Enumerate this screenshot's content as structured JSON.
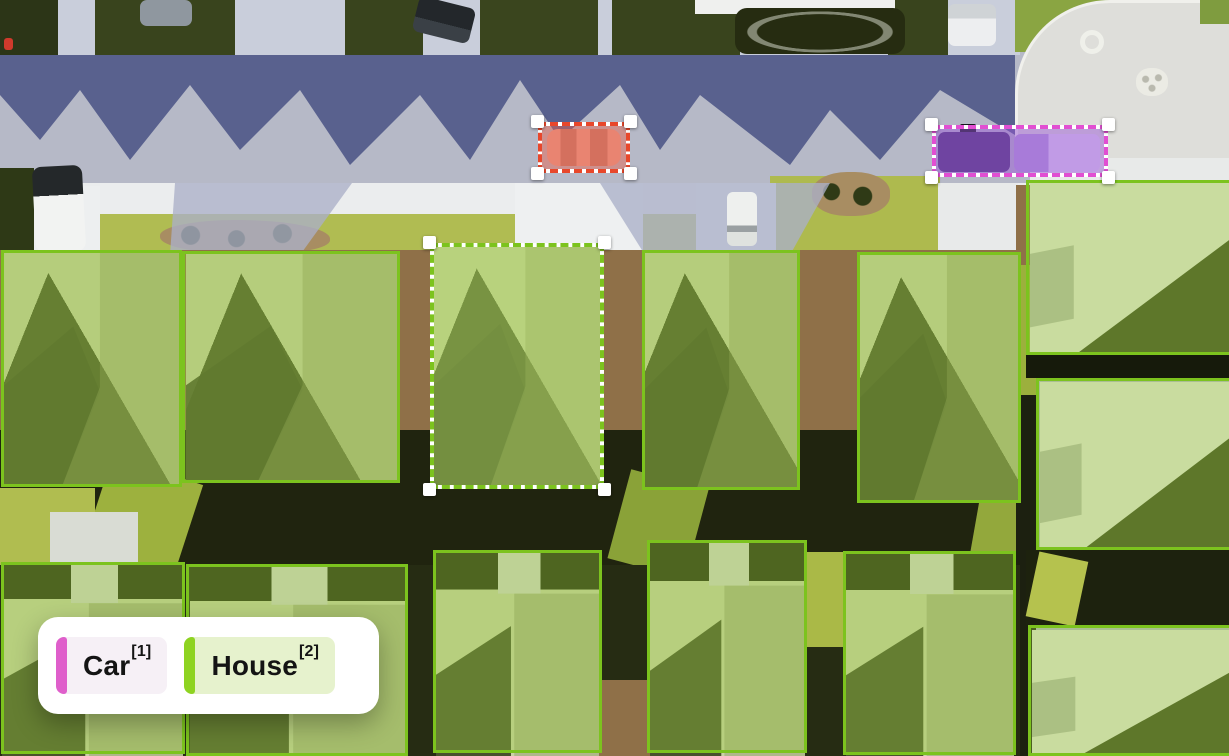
{
  "legend": {
    "items": [
      {
        "label": "Car",
        "hotkey": "[1]",
        "bar_color": "#df5fcb",
        "bg_color": "#f6f0f6"
      },
      {
        "label": "House",
        "hotkey": "[2]",
        "bar_color": "#8ed321",
        "bg_color": "#e6f2cd"
      }
    ]
  },
  "annotations": {
    "styles": {
      "house": {
        "stroke": "#7cc31e",
        "fill": "rgba(149,201,61,0.38)"
      },
      "house_selected": {
        "stroke": "#7cc31e",
        "fill": "rgba(167,212,88,0.50)"
      },
      "car_red": {
        "stroke": "#e8472b",
        "fill": "rgba(234,95,70,0.45)"
      },
      "car_magenta": {
        "stroke": "#e14fd2",
        "fill": "rgba(152,86,214,0.48)"
      }
    },
    "boxes": [
      {
        "id": "house-1",
        "cls": "House",
        "variant": "house",
        "style": "solid",
        "handles": false,
        "x": 1,
        "y": 250,
        "w": 181,
        "h": 237
      },
      {
        "id": "house-2",
        "cls": "House",
        "variant": "house",
        "style": "solid",
        "handles": false,
        "x": 182,
        "y": 251,
        "w": 218,
        "h": 232
      },
      {
        "id": "house-3",
        "cls": "House",
        "variant": "house_selected",
        "style": "dashed",
        "handles": true,
        "x": 430,
        "y": 243,
        "w": 174,
        "h": 246
      },
      {
        "id": "house-4",
        "cls": "House",
        "variant": "house",
        "style": "solid",
        "handles": false,
        "x": 642,
        "y": 250,
        "w": 158,
        "h": 240
      },
      {
        "id": "house-5",
        "cls": "House",
        "variant": "house",
        "style": "solid",
        "handles": false,
        "x": 857,
        "y": 252,
        "w": 164,
        "h": 251
      },
      {
        "id": "house-6",
        "cls": "House",
        "variant": "house",
        "style": "solid",
        "handles": false,
        "x": 1026,
        "y": 180,
        "w": 210,
        "h": 175
      },
      {
        "id": "house-7",
        "cls": "House",
        "variant": "house",
        "style": "solid",
        "handles": false,
        "x": 1036,
        "y": 378,
        "w": 200,
        "h": 172
      },
      {
        "id": "house-8",
        "cls": "House",
        "variant": "house",
        "style": "solid",
        "handles": false,
        "x": 1,
        "y": 562,
        "w": 184,
        "h": 192
      },
      {
        "id": "house-9",
        "cls": "House",
        "variant": "house",
        "style": "solid",
        "handles": false,
        "x": 186,
        "y": 564,
        "w": 222,
        "h": 192
      },
      {
        "id": "house-10",
        "cls": "House",
        "variant": "house",
        "style": "solid",
        "handles": false,
        "x": 433,
        "y": 550,
        "w": 169,
        "h": 203
      },
      {
        "id": "house-11",
        "cls": "House",
        "variant": "house",
        "style": "solid",
        "handles": false,
        "x": 647,
        "y": 540,
        "w": 160,
        "h": 213
      },
      {
        "id": "house-12",
        "cls": "House",
        "variant": "house",
        "style": "solid",
        "handles": false,
        "x": 843,
        "y": 551,
        "w": 173,
        "h": 204
      },
      {
        "id": "house-13",
        "cls": "House",
        "variant": "house",
        "style": "solid",
        "handles": false,
        "x": 1028,
        "y": 625,
        "w": 208,
        "h": 131
      },
      {
        "id": "car-1",
        "cls": "Car",
        "variant": "car_red",
        "style": "dashed",
        "handles": true,
        "x": 538,
        "y": 122,
        "w": 92,
        "h": 51
      },
      {
        "id": "car-2",
        "cls": "Car",
        "variant": "car_magenta",
        "style": "dashed",
        "handles": true,
        "x": 932,
        "y": 125,
        "w": 176,
        "h": 52
      }
    ]
  }
}
